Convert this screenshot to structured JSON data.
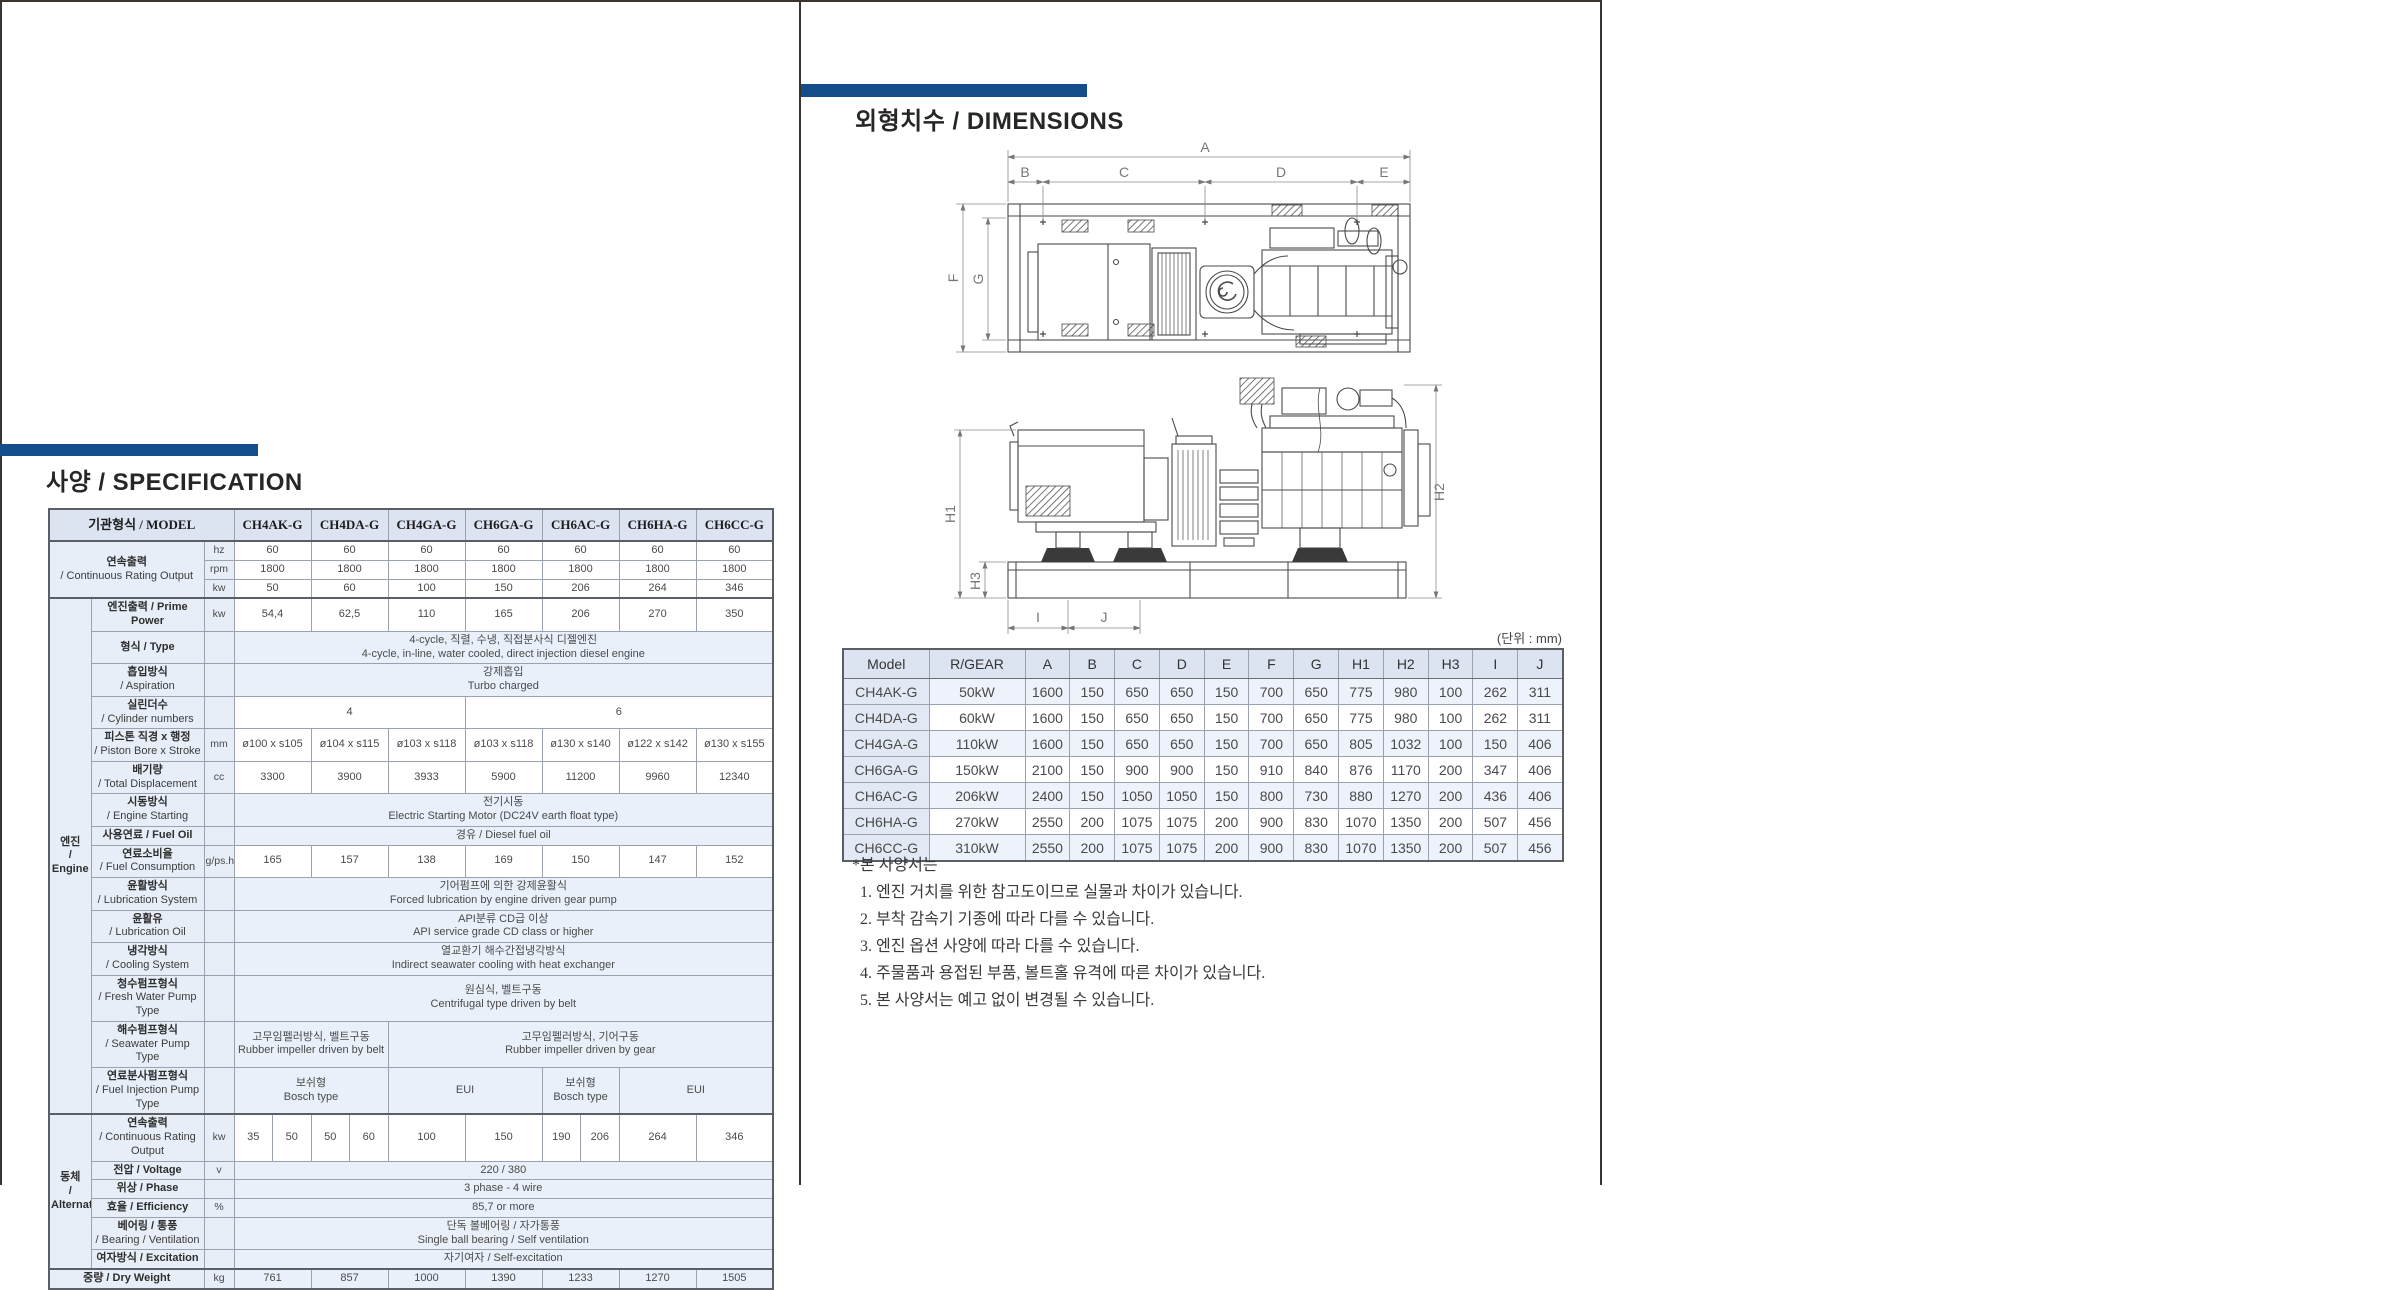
{
  "page_left": {
    "title": "사양 / SPECIFICATION",
    "spec_table": {
      "corner": "기관형식 / MODEL",
      "models": [
        "CH4AK-G",
        "CH4DA-G",
        "CH4GA-G",
        "CH6GA-G",
        "CH6AC-G",
        "CH6HA-G",
        "CH6CC-G"
      ],
      "engine_group": "엔진|/ Engine",
      "alt_group": "동체|/ Alternator",
      "rows": [
        {
          "label": "연속출력|/ Continuous Rating Output",
          "span_group": true,
          "label_rowspan": 3,
          "unit": "hz",
          "cells": [
            [
              2,
              "60"
            ],
            [
              2,
              "60"
            ],
            [
              2,
              "60"
            ],
            [
              2,
              "60"
            ],
            [
              2,
              "60"
            ],
            [
              2,
              "60"
            ],
            [
              2,
              "60"
            ]
          ]
        },
        {
          "no_label": true,
          "unit": "rpm",
          "cells": [
            [
              2,
              "1800"
            ],
            [
              2,
              "1800"
            ],
            [
              2,
              "1800"
            ],
            [
              2,
              "1800"
            ],
            [
              2,
              "1800"
            ],
            [
              2,
              "1800"
            ],
            [
              2,
              "1800"
            ]
          ]
        },
        {
          "no_label": true,
          "unit": "kw",
          "cells": [
            [
              2,
              "50"
            ],
            [
              2,
              "60"
            ],
            [
              2,
              "100"
            ],
            [
              2,
              "150"
            ],
            [
              2,
              "206"
            ],
            [
              2,
              "264"
            ],
            [
              2,
              "346"
            ]
          ]
        },
        {
          "group": "engine",
          "group_rowspan": 15,
          "top2": true,
          "label": "엔진출력 / Prime Power",
          "unit": "kw",
          "cells": [
            [
              2,
              "54,4"
            ],
            [
              2,
              "62,5"
            ],
            [
              2,
              "110"
            ],
            [
              2,
              "165"
            ],
            [
              2,
              "206"
            ],
            [
              2,
              "270"
            ],
            [
              2,
              "350"
            ]
          ]
        },
        {
          "label": "형식 / Type",
          "tint": true,
          "cells": [
            [
              14,
              "4-cycle, 직렬, 수냉, 직접분사식 디젤엔진|4-cycle, in-line, water cooled, direct injection diesel engine"
            ]
          ]
        },
        {
          "label": "흡입방식|/ Aspiration",
          "tint": true,
          "cells": [
            [
              14,
              "강제흡입|Turbo charged"
            ]
          ]
        },
        {
          "label": "실린더수|/ Cylinder numbers",
          "cells": [
            [
              6,
              "4"
            ],
            [
              8,
              "6"
            ]
          ]
        },
        {
          "label": "피스톤 직경 x 행정|/ Piston Bore x Stroke",
          "unit": "mm",
          "cells": [
            [
              2,
              "ø100 x s105"
            ],
            [
              2,
              "ø104 x s115"
            ],
            [
              2,
              "ø103 x s118"
            ],
            [
              2,
              "ø103 x s118"
            ],
            [
              2,
              "ø130 x s140"
            ],
            [
              2,
              "ø122 x s142"
            ],
            [
              2,
              "ø130 x s155"
            ]
          ]
        },
        {
          "label": "배기량|/ Total Displacement",
          "unit": "cc",
          "cells": [
            [
              2,
              "3300"
            ],
            [
              2,
              "3900"
            ],
            [
              2,
              "3933"
            ],
            [
              2,
              "5900"
            ],
            [
              2,
              "11200"
            ],
            [
              2,
              "9960"
            ],
            [
              2,
              "12340"
            ]
          ]
        },
        {
          "label": "시동방식|/ Engine Starting",
          "tint": true,
          "cells": [
            [
              14,
              "전기시동|Electric Starting Motor (DC24V earth float type)"
            ]
          ]
        },
        {
          "label": "사용연료 / Fuel Oil",
          "tint": true,
          "cells": [
            [
              14,
              "경유 / Diesel fuel oil"
            ]
          ]
        },
        {
          "label": "연료소비율|/ Fuel Consumption",
          "unit": "g/ps.h",
          "cells": [
            [
              2,
              "165"
            ],
            [
              2,
              "157"
            ],
            [
              2,
              "138"
            ],
            [
              2,
              "169"
            ],
            [
              2,
              "150"
            ],
            [
              2,
              "147"
            ],
            [
              2,
              "152"
            ]
          ]
        },
        {
          "label": "윤활방식|/ Lubrication System",
          "tint": true,
          "cells": [
            [
              14,
              "기어펌프에 의한 강제윤활식|Forced lubrication by engine driven gear pump"
            ]
          ]
        },
        {
          "label": "윤활유|/ Lubrication Oil",
          "tint": true,
          "cells": [
            [
              14,
              "API분류 CD급 이상|API service grade CD class or higher"
            ]
          ]
        },
        {
          "label": "냉각방식|/ Cooling System",
          "tint": true,
          "cells": [
            [
              14,
              "열교환기 해수간접냉각방식|Indirect seawater cooling with heat exchanger"
            ]
          ]
        },
        {
          "label": "청수펌프형식|/ Fresh Water Pump Type",
          "tint": true,
          "cells": [
            [
              14,
              "원심식, 벨트구동|Centrifugal type driven by belt"
            ]
          ]
        },
        {
          "label": "해수펌프형식|/ Seawater Pump Type",
          "tint": true,
          "cells": [
            [
              4,
              "고무임펠러방식, 벨트구동|Rubber impeller driven by belt"
            ],
            [
              10,
              "고무임펠러방식, 기어구동|Rubber impeller driven by gear"
            ]
          ]
        },
        {
          "label": "연료분사펌프형식|/ Fuel Injection Pump Type",
          "tint": true,
          "cells": [
            [
              4,
              "보쉬형|Bosch type"
            ],
            [
              4,
              "EUI"
            ],
            [
              2,
              "보쉬형|Bosch type"
            ],
            [
              4,
              "EUI"
            ]
          ]
        },
        {
          "group": "alt",
          "group_rowspan": 6,
          "top2": true,
          "label": "연속출력|/ Continuous Rating Output",
          "unit": "kw",
          "cells": [
            [
              1,
              "35"
            ],
            [
              1,
              "50"
            ],
            [
              1,
              "50"
            ],
            [
              1,
              "60"
            ],
            [
              2,
              "100"
            ],
            [
              2,
              "150"
            ],
            [
              1,
              "190"
            ],
            [
              1,
              "206"
            ],
            [
              2,
              "264"
            ],
            [
              2,
              "346"
            ]
          ]
        },
        {
          "label": "전압 / Voltage",
          "unit": "v",
          "tint": true,
          "cells": [
            [
              14,
              "220 / 380"
            ]
          ]
        },
        {
          "label": "위상 / Phase",
          "tint": true,
          "cells": [
            [
              14,
              "3 phase - 4 wire"
            ]
          ]
        },
        {
          "label": "효율 / Efficiency",
          "unit": "%",
          "tint": true,
          "cells": [
            [
              14,
              "85,7 or more"
            ]
          ]
        },
        {
          "label": "베어링 / 통풍|/ Bearing / Ventilation",
          "tint": true,
          "cells": [
            [
              14,
              "단독 볼베어링 / 자가통풍|Single ball bearing / Self ventilation"
            ]
          ]
        },
        {
          "label": "여자방식 / Excitation",
          "tint": true,
          "cells": [
            [
              14,
              "자기여자 / Self-excitation"
            ]
          ]
        },
        {
          "label": "중량 / Dry Weight",
          "span_group": true,
          "top2": true,
          "unit": "kg",
          "tint": true,
          "cells": [
            [
              2,
              "761"
            ],
            [
              2,
              "857"
            ],
            [
              2,
              "1000"
            ],
            [
              2,
              "1390"
            ],
            [
              2,
              "1233"
            ],
            [
              2,
              "1270"
            ],
            [
              2,
              "1505"
            ]
          ]
        }
      ]
    }
  },
  "page_right": {
    "title": "외형치수 / DIMENSIONS",
    "unit_note": "(단위 : mm)",
    "dim_table": {
      "headers": [
        "Model",
        "R/GEAR",
        "A",
        "B",
        "C",
        "D",
        "E",
        "F",
        "G",
        "H1",
        "H2",
        "H3",
        "I",
        "J"
      ],
      "rows": [
        [
          "CH4AK-G",
          "50kW",
          "1600",
          "150",
          "650",
          "650",
          "150",
          "700",
          "650",
          "775",
          "980",
          "100",
          "262",
          "311"
        ],
        [
          "CH4DA-G",
          "60kW",
          "1600",
          "150",
          "650",
          "650",
          "150",
          "700",
          "650",
          "775",
          "980",
          "100",
          "262",
          "311"
        ],
        [
          "CH4GA-G",
          "110kW",
          "1600",
          "150",
          "650",
          "650",
          "150",
          "700",
          "650",
          "805",
          "1032",
          "100",
          "150",
          "406"
        ],
        [
          "CH6GA-G",
          "150kW",
          "2100",
          "150",
          "900",
          "900",
          "150",
          "910",
          "840",
          "876",
          "1170",
          "200",
          "347",
          "406"
        ],
        [
          "CH6AC-G",
          "206kW",
          "2400",
          "150",
          "1050",
          "1050",
          "150",
          "800",
          "730",
          "880",
          "1270",
          "200",
          "436",
          "406"
        ],
        [
          "CH6HA-G",
          "270kW",
          "2550",
          "200",
          "1075",
          "1075",
          "200",
          "900",
          "830",
          "1070",
          "1350",
          "200",
          "507",
          "456"
        ],
        [
          "CH6CC-G",
          "310kW",
          "2550",
          "200",
          "1075",
          "1075",
          "200",
          "900",
          "830",
          "1070",
          "1350",
          "200",
          "507",
          "456"
        ]
      ]
    },
    "drawing": {
      "plan": {
        "A": "A",
        "B": "B",
        "C": "C",
        "D": "D",
        "E": "E",
        "F": "F",
        "G": "G"
      },
      "side": {
        "H1": "H1",
        "H2": "H2",
        "H3": "H3",
        "I": "I",
        "J": "J"
      }
    },
    "notes": [
      "*본 사양서는",
      "  1. 엔진 거치를 위한 참고도이므로 실물과 차이가 있습니다.",
      "  2. 부착 감속기 기종에 따라 다를 수 있습니다.",
      "  3. 엔진 옵션 사양에 따라 다를 수 있습니다.",
      "  4. 주물품과 용접된 부품, 볼트홀 유격에 따른 차이가 있습니다.",
      "  5. 본 사양서는 예고 없이 변경될 수 있습니다."
    ],
    "accent_color": "#134e8b"
  }
}
